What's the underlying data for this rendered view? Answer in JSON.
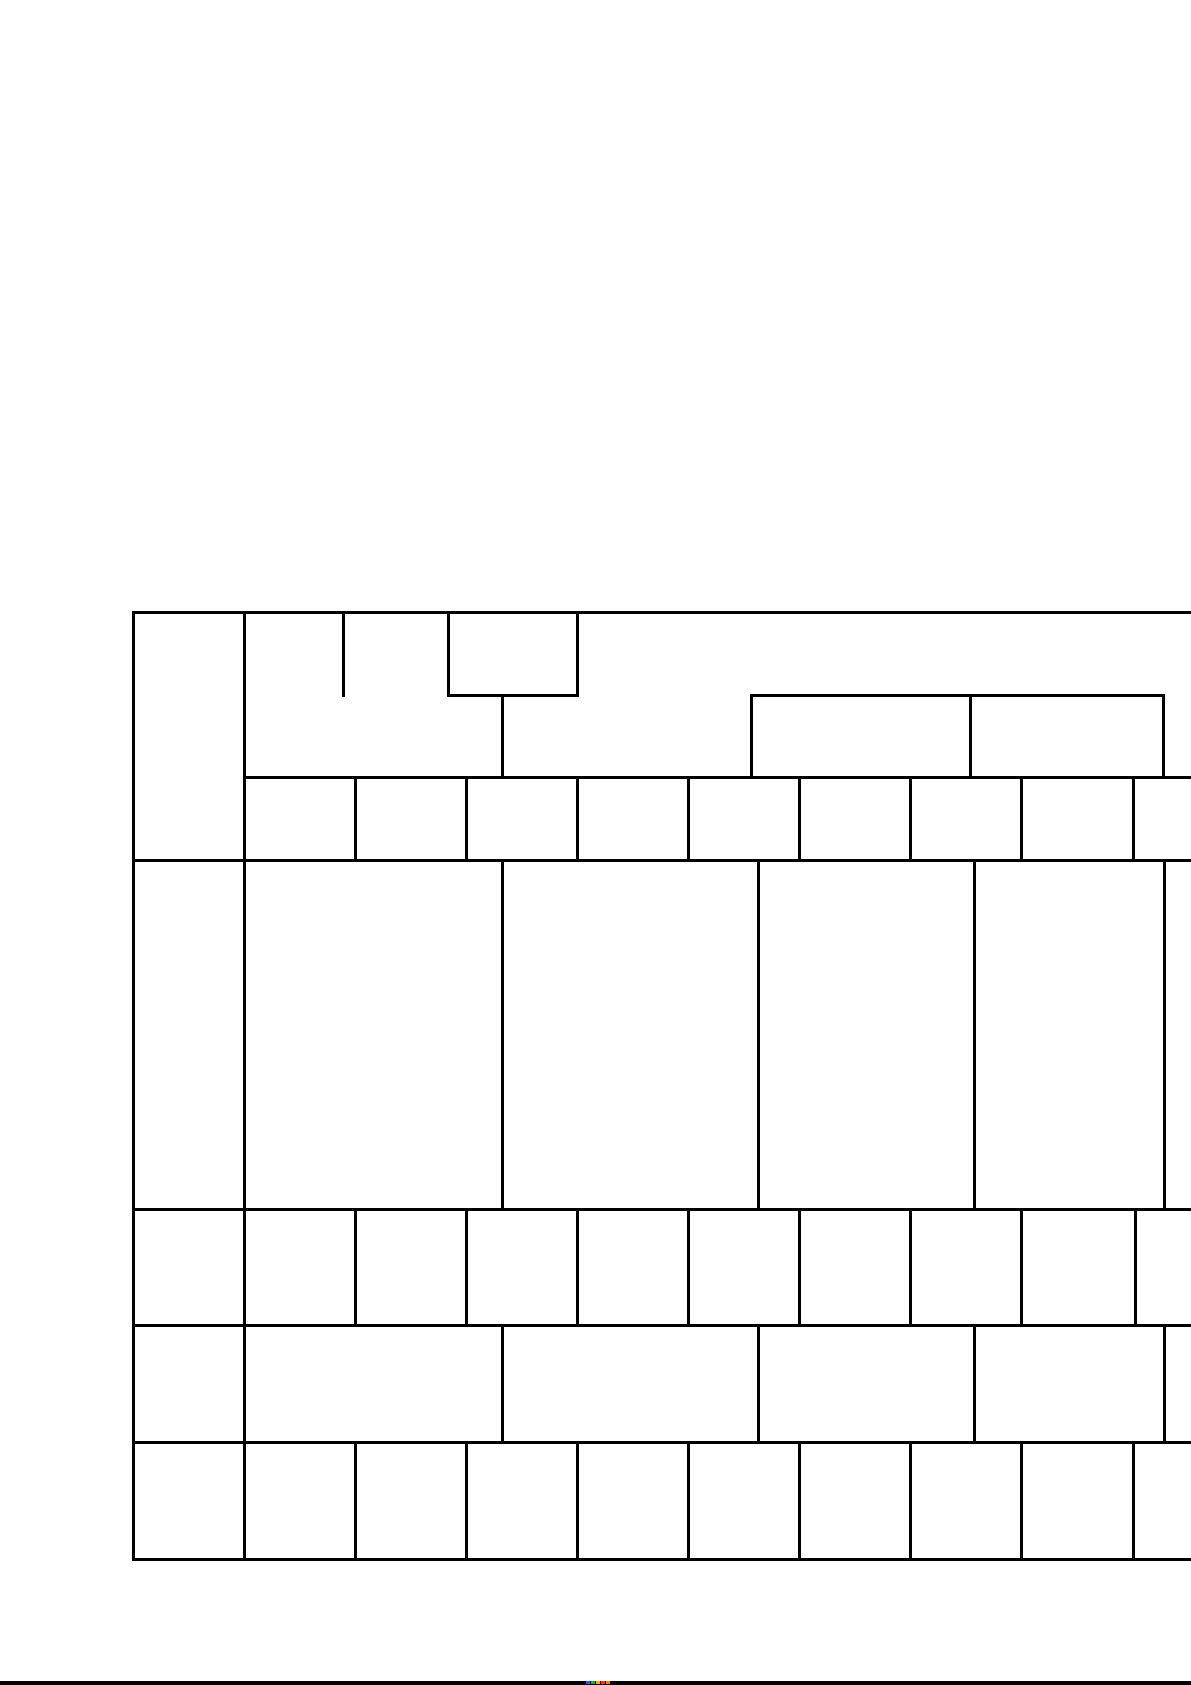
{
  "page": {
    "width": 1191,
    "height": 1685,
    "background_color": "#ffffff"
  },
  "table": {
    "line_color": "#000000",
    "line_thickness": 3,
    "left": 133,
    "top": 612,
    "right": 1191,
    "bottom": 1559,
    "h_segments": [
      {
        "y": 612,
        "x1": 133,
        "x2": 1191
      },
      {
        "y": 695,
        "x1": 448,
        "x2": 577
      },
      {
        "y": 695,
        "x1": 751,
        "x2": 1163
      },
      {
        "y": 777,
        "x1": 244,
        "x2": 1191
      },
      {
        "y": 860,
        "x1": 133,
        "x2": 1191
      },
      {
        "y": 1209,
        "x1": 133,
        "x2": 1191
      },
      {
        "y": 1325,
        "x1": 133,
        "x2": 1191
      },
      {
        "y": 1442,
        "x1": 133,
        "x2": 1191
      },
      {
        "y": 1559,
        "x1": 133,
        "x2": 1191
      }
    ],
    "v_segments": [
      {
        "x": 133,
        "y1": 612,
        "y2": 1559
      },
      {
        "x": 244,
        "y1": 612,
        "y2": 1559
      },
      {
        "x": 343,
        "y1": 612,
        "y2": 695
      },
      {
        "x": 448,
        "y1": 612,
        "y2": 695
      },
      {
        "x": 577,
        "y1": 612,
        "y2": 695
      },
      {
        "x": 502,
        "y1": 695,
        "y2": 777
      },
      {
        "x": 751,
        "y1": 695,
        "y2": 777
      },
      {
        "x": 970,
        "y1": 695,
        "y2": 777
      },
      {
        "x": 1163,
        "y1": 695,
        "y2": 777
      },
      {
        "x": 355,
        "y1": 777,
        "y2": 860
      },
      {
        "x": 466,
        "y1": 777,
        "y2": 860
      },
      {
        "x": 577,
        "y1": 777,
        "y2": 860
      },
      {
        "x": 688,
        "y1": 777,
        "y2": 860
      },
      {
        "x": 799,
        "y1": 777,
        "y2": 860
      },
      {
        "x": 910,
        "y1": 777,
        "y2": 860
      },
      {
        "x": 1021,
        "y1": 777,
        "y2": 860
      },
      {
        "x": 1133,
        "y1": 777,
        "y2": 860
      },
      {
        "x": 502,
        "y1": 860,
        "y2": 1209
      },
      {
        "x": 758,
        "y1": 860,
        "y2": 1209
      },
      {
        "x": 974,
        "y1": 860,
        "y2": 1209
      },
      {
        "x": 1164,
        "y1": 860,
        "y2": 1209
      },
      {
        "x": 355,
        "y1": 1209,
        "y2": 1325
      },
      {
        "x": 466,
        "y1": 1209,
        "y2": 1325
      },
      {
        "x": 577,
        "y1": 1209,
        "y2": 1325
      },
      {
        "x": 688,
        "y1": 1209,
        "y2": 1325
      },
      {
        "x": 799,
        "y1": 1209,
        "y2": 1325
      },
      {
        "x": 910,
        "y1": 1209,
        "y2": 1325
      },
      {
        "x": 1021,
        "y1": 1209,
        "y2": 1325
      },
      {
        "x": 1135,
        "y1": 1209,
        "y2": 1325
      },
      {
        "x": 502,
        "y1": 1325,
        "y2": 1442
      },
      {
        "x": 758,
        "y1": 1325,
        "y2": 1442
      },
      {
        "x": 974,
        "y1": 1325,
        "y2": 1442
      },
      {
        "x": 1164,
        "y1": 1325,
        "y2": 1442
      },
      {
        "x": 355,
        "y1": 1442,
        "y2": 1559
      },
      {
        "x": 466,
        "y1": 1442,
        "y2": 1559
      },
      {
        "x": 577,
        "y1": 1442,
        "y2": 1559
      },
      {
        "x": 688,
        "y1": 1442,
        "y2": 1559
      },
      {
        "x": 799,
        "y1": 1442,
        "y2": 1559
      },
      {
        "x": 910,
        "y1": 1442,
        "y2": 1559
      },
      {
        "x": 1021,
        "y1": 1442,
        "y2": 1559
      },
      {
        "x": 1133,
        "y1": 1442,
        "y2": 1559
      }
    ]
  },
  "bottom_bar": {
    "color": "#000000",
    "y": 1681,
    "height": 4,
    "color_pixels": [
      {
        "x": 586,
        "color": "#3355ee"
      },
      {
        "x": 591,
        "color": "#22aa44"
      },
      {
        "x": 596,
        "color": "#ffaa00"
      },
      {
        "x": 601,
        "color": "#ee3322"
      },
      {
        "x": 606,
        "color": "#ff7700"
      }
    ]
  }
}
